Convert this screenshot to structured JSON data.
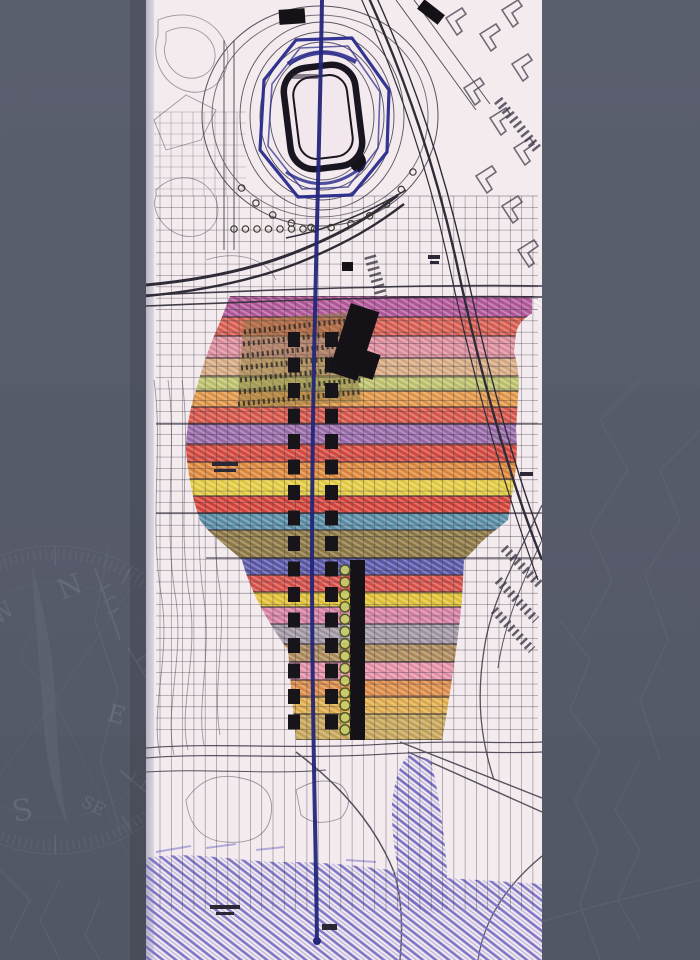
{
  "slide": {
    "background_color": "#575c6b",
    "watermark": {
      "icon": "compass-rose",
      "line_color": "#7d8292",
      "contour_color": "#6d7283"
    }
  },
  "map_scan": {
    "kind": "scanned hand-colored urban master plan with stadium and axis",
    "paper_color": "#f4ebef",
    "edge_strip_colors": [
      "#b9b5c2",
      "#dcd8e2"
    ],
    "ink_color": "#57525f",
    "road_color": "#2f2c38",
    "grid_color": "#35313e",
    "axis_line_color": "#232679",
    "stadium_outline_color": "#23258a",
    "stadium_ring_color": "#191621",
    "water_hatch_colors": [
      "#776fc3",
      "#9c96d6"
    ],
    "tower_color": "#17151a",
    "terrace_color": "#907c3f",
    "green_circles": {
      "count": 14,
      "start_y": 570,
      "step": 12.3,
      "fill": "#c9cf6d",
      "stroke": "#49521c"
    },
    "tower_rows": {
      "count": 16,
      "start_y": 332,
      "step": 25.5
    },
    "zoning_bands": [
      {
        "y": 296,
        "h": 21,
        "color": "#b4599b"
      },
      {
        "y": 317,
        "h": 19,
        "color": "#d95f52"
      },
      {
        "y": 336,
        "h": 22,
        "color": "#de8f9e"
      },
      {
        "y": 358,
        "h": 18,
        "color": "#d9ad84"
      },
      {
        "y": 376,
        "h": 15,
        "color": "#bfc46e"
      },
      {
        "y": 391,
        "h": 16,
        "color": "#e3994a"
      },
      {
        "y": 407,
        "h": 17,
        "color": "#d8574a"
      },
      {
        "y": 424,
        "h": 20,
        "color": "#9a6cab"
      },
      {
        "y": 444,
        "h": 18,
        "color": "#d74b40"
      },
      {
        "y": 462,
        "h": 17,
        "color": "#e08a3c"
      },
      {
        "y": 479,
        "h": 17,
        "color": "#e5ce44"
      },
      {
        "y": 496,
        "h": 17,
        "color": "#d5443a"
      },
      {
        "y": 513,
        "h": 17,
        "color": "#5a8fa8"
      },
      {
        "y": 530,
        "h": 28,
        "color": "#8f7a45"
      },
      {
        "y": 558,
        "h": 17,
        "color": "#5b5aab"
      },
      {
        "y": 575,
        "h": 17,
        "color": "#d85148"
      },
      {
        "y": 592,
        "h": 15,
        "color": "#e3c237"
      },
      {
        "y": 607,
        "h": 17,
        "color": "#d883a5"
      },
      {
        "y": 624,
        "h": 20,
        "color": "#a299a5"
      },
      {
        "y": 644,
        "h": 18,
        "color": "#ae8c5c"
      },
      {
        "y": 662,
        "h": 18,
        "color": "#e692a8"
      },
      {
        "y": 680,
        "h": 17,
        "color": "#de8e49"
      },
      {
        "y": 697,
        "h": 17,
        "color": "#e1af4d"
      },
      {
        "y": 714,
        "h": 26,
        "color": "#c7a75a"
      }
    ]
  }
}
